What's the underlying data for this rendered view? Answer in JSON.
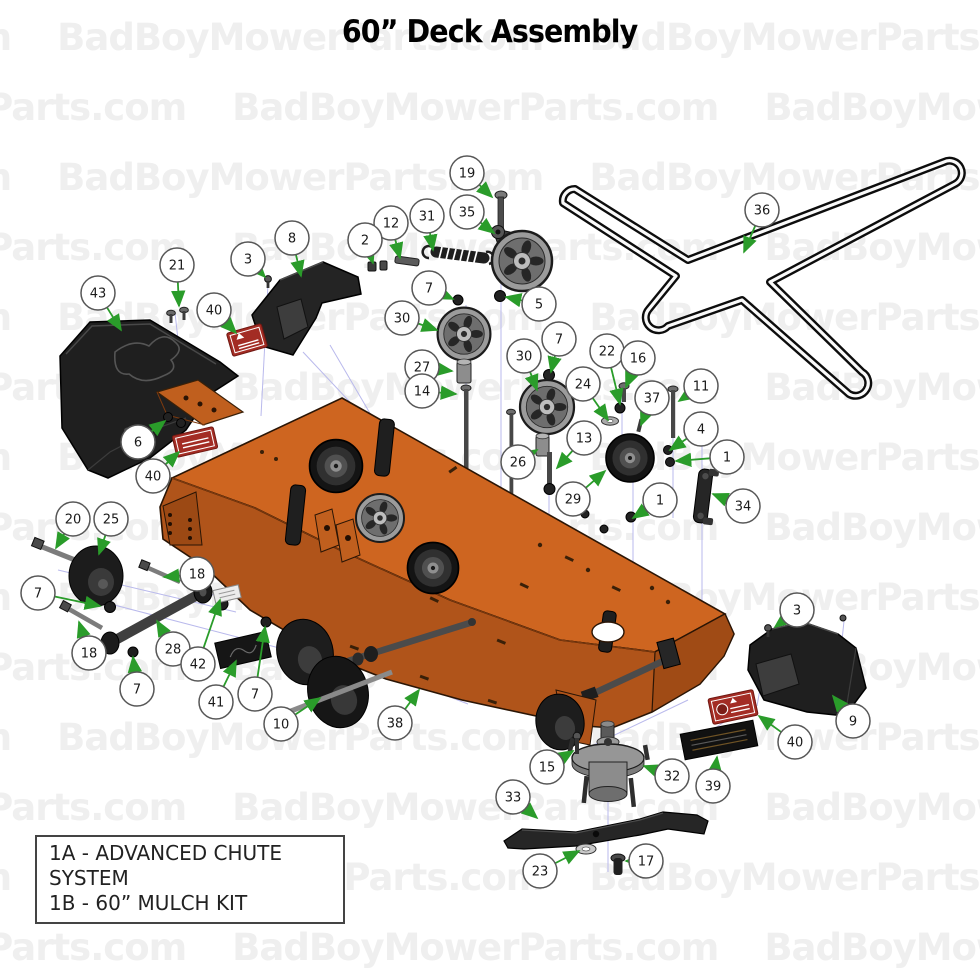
{
  "title": "60” Deck Assembly",
  "watermark": {
    "text": "BadBoyMowerParts.com",
    "color": "#efefef"
  },
  "legend": {
    "items": [
      "1A - ADVANCED CHUTE SYSTEM",
      "1B - 60” MULCH KIT"
    ]
  },
  "colors": {
    "deck_orange_top": "#ce6520",
    "deck_orange_skirt": "#b0541a",
    "deck_orange_end": "#a04b15",
    "part_black": "#1b1b1b",
    "arrow_green": "#2a9c2a",
    "assembly_line_blue": "#b9b9ec",
    "balloon_stroke": "#575757",
    "warning_label_red": "#a32c24",
    "watermark_gray": "#efefef"
  },
  "diagram": {
    "balloon_radius": 17,
    "callouts": [
      {
        "label": "19",
        "x": 467,
        "y": 173,
        "tx": 492,
        "ty": 197
      },
      {
        "label": "35",
        "x": 467,
        "y": 212,
        "tx": 494,
        "ty": 233
      },
      {
        "label": "31",
        "x": 427,
        "y": 216,
        "tx": 433,
        "ty": 250
      },
      {
        "label": "12",
        "x": 391,
        "y": 223,
        "tx": 400,
        "ty": 258
      },
      {
        "label": "2",
        "x": 365,
        "y": 240,
        "tx": 373,
        "ty": 263
      },
      {
        "label": "8",
        "x": 292,
        "y": 238,
        "tx": 301,
        "ty": 276
      },
      {
        "label": "3",
        "x": 248,
        "y": 259,
        "tx": 265,
        "ty": 277
      },
      {
        "label": "21",
        "x": 177,
        "y": 265,
        "tx": 179,
        "ty": 306
      },
      {
        "label": "43",
        "x": 98,
        "y": 293,
        "tx": 121,
        "ty": 330
      },
      {
        "label": "40",
        "x": 214,
        "y": 310,
        "tx": 236,
        "ty": 333
      },
      {
        "label": "7",
        "x": 429,
        "y": 288,
        "tx": 453,
        "ty": 299
      },
      {
        "label": "5",
        "x": 539,
        "y": 304,
        "tx": 506,
        "ty": 297
      },
      {
        "label": "30",
        "x": 402,
        "y": 318,
        "tx": 437,
        "ty": 330
      },
      {
        "label": "27",
        "x": 422,
        "y": 367,
        "tx": 452,
        "ty": 371
      },
      {
        "label": "14",
        "x": 422,
        "y": 391,
        "tx": 456,
        "ty": 394
      },
      {
        "label": "7",
        "x": 559,
        "y": 339,
        "tx": 551,
        "ty": 372
      },
      {
        "label": "30",
        "x": 524,
        "y": 356,
        "tx": 537,
        "ty": 390
      },
      {
        "label": "22",
        "x": 607,
        "y": 351,
        "tx": 620,
        "ty": 404
      },
      {
        "label": "16",
        "x": 638,
        "y": 358,
        "tx": 626,
        "ty": 387
      },
      {
        "label": "24",
        "x": 583,
        "y": 384,
        "tx": 608,
        "ty": 420
      },
      {
        "label": "37",
        "x": 652,
        "y": 398,
        "tx": 641,
        "ty": 425
      },
      {
        "label": "11",
        "x": 701,
        "y": 386,
        "tx": 679,
        "ty": 401
      },
      {
        "label": "4",
        "x": 701,
        "y": 429,
        "tx": 670,
        "ty": 450
      },
      {
        "label": "1",
        "x": 727,
        "y": 457,
        "tx": 676,
        "ty": 461
      },
      {
        "label": "26",
        "x": 518,
        "y": 462,
        "tx": 537,
        "ty": 450
      },
      {
        "label": "13",
        "x": 584,
        "y": 438,
        "tx": 557,
        "ty": 468
      },
      {
        "label": "29",
        "x": 573,
        "y": 499,
        "tx": 605,
        "ty": 471
      },
      {
        "label": "1",
        "x": 660,
        "y": 500,
        "tx": 633,
        "ty": 518
      },
      {
        "label": "34",
        "x": 743,
        "y": 506,
        "tx": 713,
        "ty": 494
      },
      {
        "label": "36",
        "x": 762,
        "y": 210,
        "tx": 744,
        "ty": 252
      },
      {
        "label": "6",
        "x": 138,
        "y": 442,
        "tx": 165,
        "ty": 421
      },
      {
        "label": "40",
        "x": 153,
        "y": 476,
        "tx": 179,
        "ty": 452
      },
      {
        "label": "20",
        "x": 73,
        "y": 519,
        "tx": 56,
        "ty": 548
      },
      {
        "label": "25",
        "x": 111,
        "y": 519,
        "tx": 99,
        "ty": 554
      },
      {
        "label": "7",
        "x": 38,
        "y": 593,
        "tx": 100,
        "ty": 606
      },
      {
        "label": "18",
        "x": 197,
        "y": 574,
        "tx": 164,
        "ty": 577
      },
      {
        "label": "18",
        "x": 89,
        "y": 653,
        "tx": 79,
        "ty": 622
      },
      {
        "label": "28",
        "x": 173,
        "y": 649,
        "tx": 157,
        "ty": 621
      },
      {
        "label": "42",
        "x": 198,
        "y": 664,
        "tx": 220,
        "ty": 600
      },
      {
        "label": "7",
        "x": 137,
        "y": 689,
        "tx": 133,
        "ty": 657
      },
      {
        "label": "41",
        "x": 216,
        "y": 702,
        "tx": 236,
        "ty": 661
      },
      {
        "label": "7",
        "x": 255,
        "y": 694,
        "tx": 265,
        "ty": 627
      },
      {
        "label": "10",
        "x": 281,
        "y": 724,
        "tx": 320,
        "ty": 698
      },
      {
        "label": "38",
        "x": 395,
        "y": 723,
        "tx": 419,
        "ty": 690
      },
      {
        "label": "3",
        "x": 797,
        "y": 610,
        "tx": 775,
        "ty": 627
      },
      {
        "label": "9",
        "x": 853,
        "y": 721,
        "tx": 833,
        "ty": 696
      },
      {
        "label": "40",
        "x": 795,
        "y": 742,
        "tx": 759,
        "ty": 716
      },
      {
        "label": "39",
        "x": 713,
        "y": 786,
        "tx": 717,
        "ty": 757
      },
      {
        "label": "15",
        "x": 547,
        "y": 767,
        "tx": 573,
        "ty": 751
      },
      {
        "label": "32",
        "x": 672,
        "y": 776,
        "tx": 644,
        "ty": 766
      },
      {
        "label": "33",
        "x": 513,
        "y": 797,
        "tx": 537,
        "ty": 818
      },
      {
        "label": "23",
        "x": 540,
        "y": 871,
        "tx": 579,
        "ty": 851
      },
      {
        "label": "17",
        "x": 646,
        "y": 861,
        "tx": 626,
        "ty": 861
      }
    ]
  }
}
